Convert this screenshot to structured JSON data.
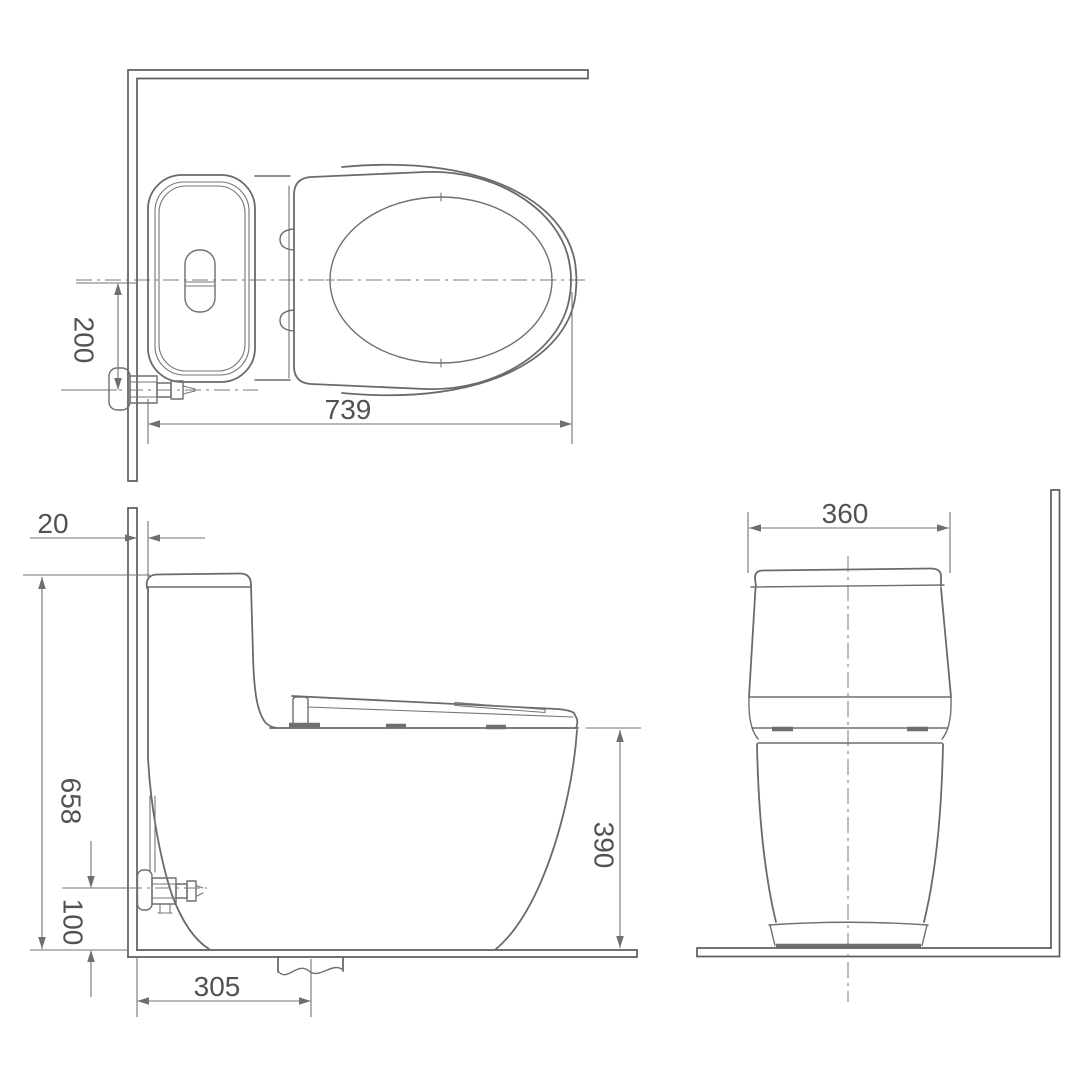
{
  "dimensions": {
    "plan": {
      "center_to_inlet": "200",
      "overall_length": "739"
    },
    "side": {
      "wall_clearance": "20",
      "overall_height": "658",
      "inlet_height": "100",
      "drain_set_out": "305",
      "rim_height": "390"
    },
    "front": {
      "tank_width": "360"
    }
  },
  "colors": {
    "object_line": "#6a6a6a",
    "dimension_line": "#737373",
    "label_text": "#525252",
    "background": "#ffffff"
  }
}
